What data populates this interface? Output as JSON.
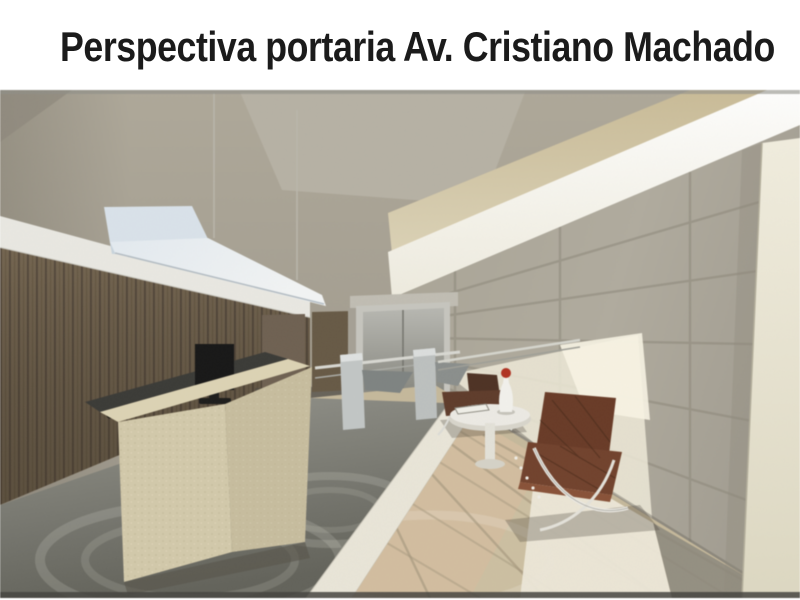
{
  "slide": {
    "title": "Perspectiva portaria Av. Cristiano Machado",
    "title_color": "#1b1b1b",
    "background": "#ffffff"
  },
  "render": {
    "subject": "3D rendering of a residential lobby (portaria) interior seen in one-point perspective",
    "elements": [
      "wood-slat-wall",
      "suspended-linear-light-fixture",
      "stone-reception-desk",
      "desktop-monitor",
      "telephone-on-desk",
      "wood-doors",
      "elevator-doors",
      "entry-turnstiles",
      "steel-handrail",
      "stone-tile-wall",
      "sunlight-patch",
      "barcelona-chair-far",
      "barcelona-chair-near",
      "round-side-table",
      "book-on-table",
      "white-vase-red-flower",
      "tiled-floor",
      "cream-column"
    ],
    "palette": {
      "wall_beige": "#a6a093",
      "ceiling": "#b5b0a2",
      "cove_light": "#f6f4ea",
      "fascia_tan": "#c8ba97",
      "tile_wall": "#aaa698",
      "wood_wall": "#74644e",
      "fixture_white": "#e5ebf0",
      "desk_stone": "#d0c6a5",
      "monitor_black": "#161616",
      "elevator_grey": "#9a9a93",
      "floor_dark": "#75756d",
      "floor_beige": "#cdbf9f",
      "floor_white_band": "#ebe6d6",
      "chair_brown": "#6f3d27",
      "chrome": "#e6e6e2",
      "flower_red": "#b5301f",
      "column_cream": "#eeead9"
    }
  }
}
